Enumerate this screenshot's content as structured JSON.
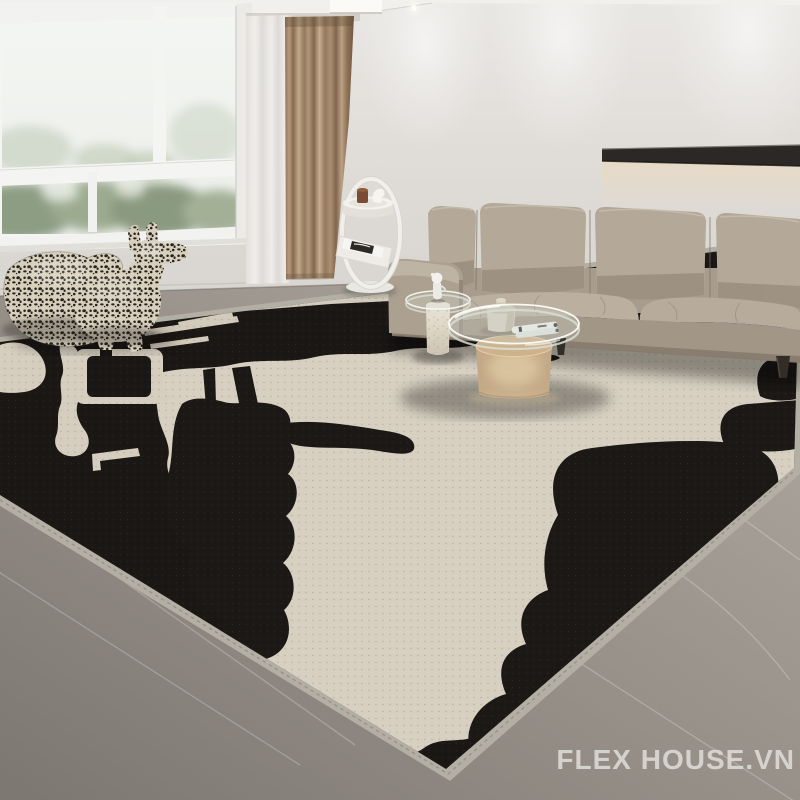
{
  "image": {
    "type": "product-photograph",
    "subject": "modern living room with black and cream abstract area rug",
    "style": "interior showcase render"
  },
  "watermark": {
    "text": "FLEX HOUSE.VN"
  },
  "colors": {
    "wall": "#e4e1dd",
    "ceiling": "#f2f1ee",
    "window_frame": "#f4f4f2",
    "sky": "#f2f4f1",
    "foliage": "#8d9d84",
    "sheer_curtain": "#eae7e3",
    "curtain": "#a88d6f",
    "curtain_dark": "#84684e",
    "curtain_light": "#c2a98a",
    "shelf": "#2b2825",
    "shelf_glow": "#eed9b4",
    "sofa": "#b4a999",
    "sofa_shadow": "#95897a",
    "sofa_base": "#a29787",
    "floor_light": "#b1aaa1",
    "floor_dark": "#7c7771",
    "rug_black": "#1a1714",
    "rug_cream": "#d7d0c1",
    "rug_binding": "#b4afa5",
    "side_table": "#f1efeb",
    "coffee_table_base": "#c3a987",
    "terrazzo": "#e8e1d3",
    "sculpture": "#d8d0bc",
    "sculpture_marks": "#26231e",
    "leg": "#332d27"
  },
  "objects": [
    {
      "name": "window",
      "description": "white framed window with greenery view"
    },
    {
      "name": "sheer-curtain",
      "description": "white sheer curtain panel"
    },
    {
      "name": "curtain",
      "description": "taupe drapery curtain"
    },
    {
      "name": "wall-shelf",
      "description": "black floating shelf with warm under-light"
    },
    {
      "name": "sofa",
      "description": "greige leather sofa with four back cushions"
    },
    {
      "name": "side-table",
      "description": "white ring side table with magazine rack"
    },
    {
      "name": "sculptures",
      "description": "two monogram-patterned animal sculptures"
    },
    {
      "name": "nesting-table",
      "description": "terrazzo pedestal table with white figurine"
    },
    {
      "name": "coffee-table",
      "description": "round glass coffee table on frosted champagne base"
    },
    {
      "name": "rug",
      "description": "black and cream abstract pattern rug with light binding"
    },
    {
      "name": "floor",
      "description": "grey marble floor"
    }
  ]
}
